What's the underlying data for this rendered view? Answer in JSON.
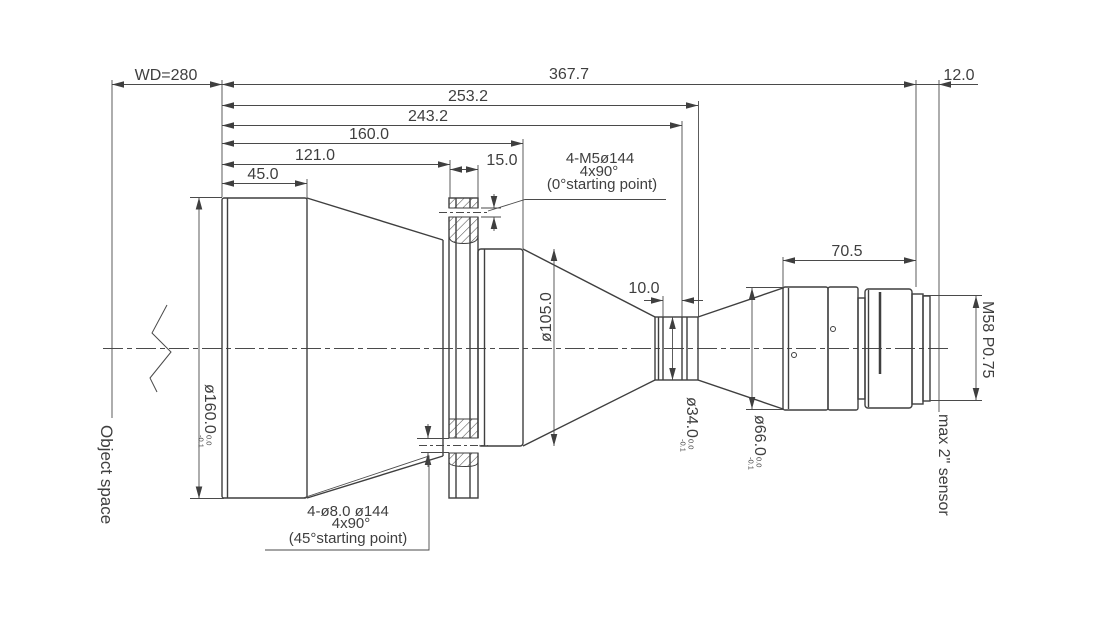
{
  "drawing": {
    "background": "#ffffff",
    "line_color": "#3f3f3f",
    "labels": {
      "object_space": "Object space",
      "sensor": "max 2\" sensor",
      "thread": "M58 P0.75"
    },
    "dimensions": {
      "wd": "WD=280",
      "total_length": "367.7",
      "len_253": "253.2",
      "len_243": "243.2",
      "len_160": "160.0",
      "len_121": "121.0",
      "len_45": "45.0",
      "flange_thickness": "15.0",
      "flange_focal": "12.0",
      "rear_length": "70.5",
      "waist_length": "10.0"
    },
    "diameters": {
      "front": {
        "value": "ø160.0",
        "tol_upper": "0.0",
        "tol_lower": "-0.1"
      },
      "mid": {
        "value": "ø105.0"
      },
      "waist": {
        "value": "ø34.0",
        "tol_upper": "0.0",
        "tol_lower": "-0.1"
      },
      "rear": {
        "value": "ø66.0",
        "tol_upper": "0.0",
        "tol_lower": "-0.1"
      }
    },
    "notes": {
      "m5": {
        "line1": "4-M5ø144",
        "line2": "4x90°",
        "line3": "(0°starting point)"
      },
      "phi8": {
        "line1": "4-ø8.0 ø144",
        "line2": "4x90°",
        "line3": "(45°starting point)"
      }
    }
  }
}
